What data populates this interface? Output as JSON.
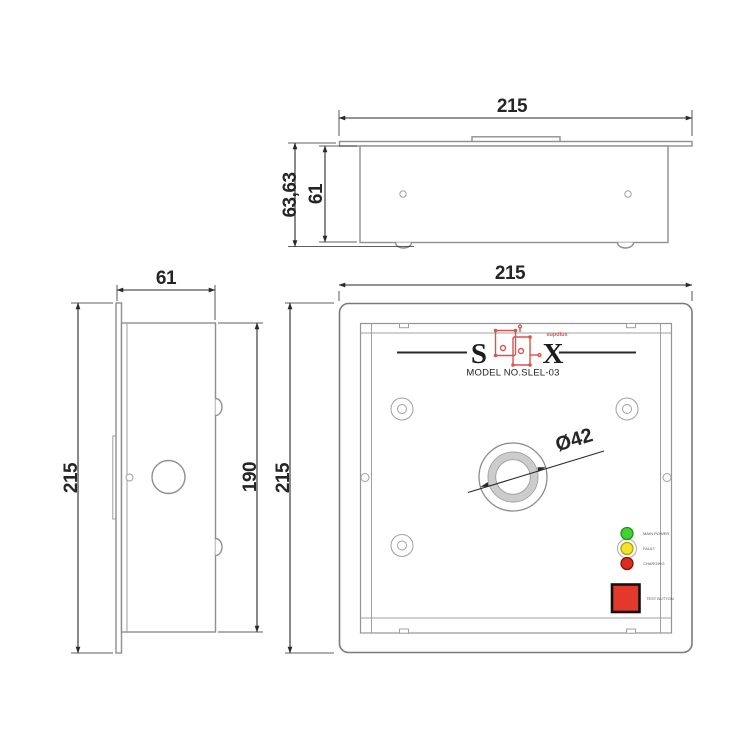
{
  "views": {
    "top": {
      "width_mm": "215",
      "outer_depth_mm": "63,63",
      "inner_depth_mm": "61"
    },
    "side": {
      "width_mm": "61",
      "outer_height_mm": "215",
      "inner_height_mm": "190"
    },
    "front": {
      "width_mm": "215",
      "height_mm": "215",
      "knockout_diameter": "Ø42",
      "logo": {
        "left_letter": "S",
        "right_letter": "X",
        "brand_text": "supdlux",
        "accent_color": "#d9534f"
      },
      "model_label": "MODEL NO.SLEL-03",
      "indicators": [
        {
          "label": "MAIN POWER",
          "color": "#3ed331"
        },
        {
          "label": "FAULT",
          "color": "#f2e32b"
        },
        {
          "label": "CHARGING",
          "color": "#dd2b1f"
        }
      ],
      "test_button": {
        "label": "TEST BUTTON",
        "color": "#e2392b"
      }
    }
  },
  "style": {
    "dimension_color": "#2a2a2a",
    "object_color": "#8f8f8f"
  }
}
